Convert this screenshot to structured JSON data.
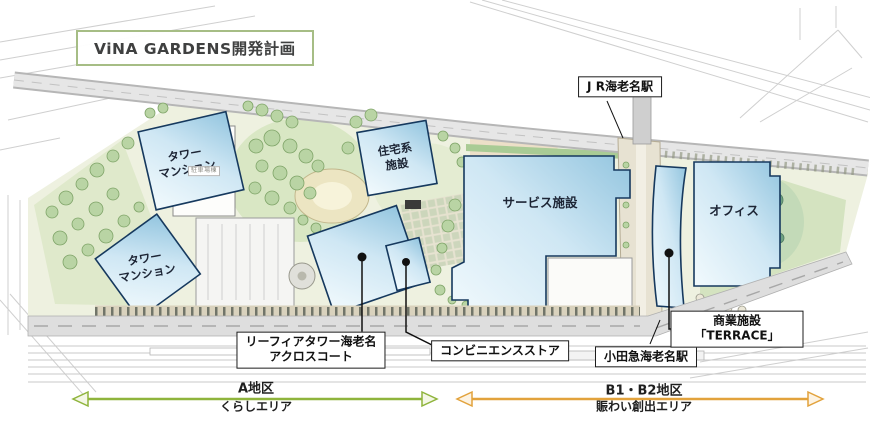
{
  "title": "ViNA GARDENS開発計画",
  "buildings": {
    "tower_mansion_upper": "タワー\nマンション",
    "tower_mansion_lower": "タワー\nマンション",
    "residential": "住宅系\n施設",
    "service": "サービス施設",
    "office": "オフィス",
    "parking": "駐車場棟"
  },
  "labels": {
    "jr_station": "J R海老名駅",
    "leafia": "リーフィアタワー海老名\nアクロスコート",
    "convenience": "コンビニエンスストア",
    "odakyu_station": "小田急海老名駅",
    "terrace": "商業施設「TERRACE」"
  },
  "districts": {
    "a": {
      "name": "A地区",
      "subtitle": "くらしエリア",
      "arrow_color": "#8fb43c"
    },
    "b": {
      "name": "B1・B2地区",
      "subtitle": "賑わい創出エリア",
      "arrow_color": "#e2a23c"
    }
  },
  "colors": {
    "building_fill_light": "#f0f9fd",
    "building_fill_dark": "#96c6e0",
    "building_stroke": "#16395e",
    "title_border": "#a6bd85",
    "site_green": "#dfe9cb",
    "road_gray": "#dedede"
  }
}
